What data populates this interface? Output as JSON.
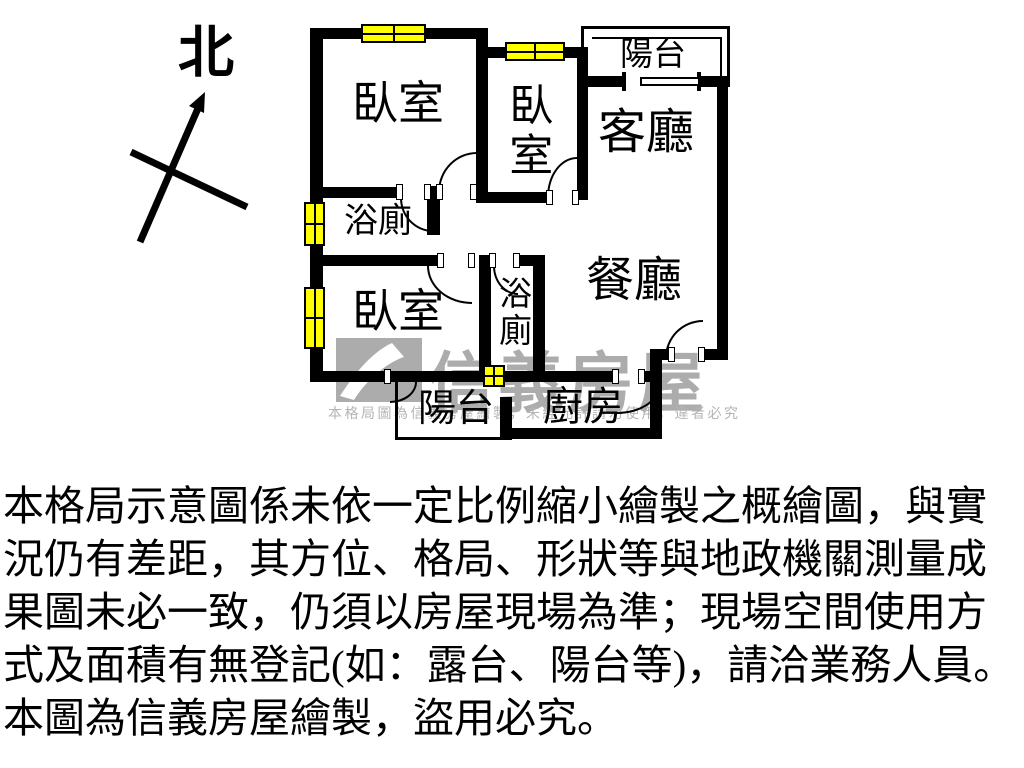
{
  "compass": {
    "label": "北"
  },
  "floorplan": {
    "rooms": {
      "bedroom_top_left": "臥室",
      "bedroom_top_middle": "臥室",
      "bedroom_bottom_left": "臥室",
      "living_room": "客廳",
      "dining_room": "餐廳",
      "bathroom_left": "浴廁",
      "bathroom_middle": "浴廁",
      "kitchen": "廚房",
      "balcony_top": "陽台",
      "balcony_bottom": "陽台"
    },
    "colors": {
      "wall": "#000000",
      "window_fill": "#FFFF00",
      "watermark_gray": "#ACACAC"
    }
  },
  "watermark": {
    "brand": "信義房屋",
    "notice": "本格局圖為信義房屋繪製，未經允許請勿使用，違者必究"
  },
  "disclaimer": {
    "lines": [
      "本格局示意圖係未依一定比例縮小繪製之概繪圖，與實",
      "況仍有差距，其方位、格局、形狀等與地政機關測量成",
      "果圖未必一致，仍須以房屋現場為準；現場空間使用方",
      "式及面積有無登記(如：露台、陽台等)，請洽業務人員。",
      "本圖為信義房屋繪製，盜用必究。"
    ]
  }
}
